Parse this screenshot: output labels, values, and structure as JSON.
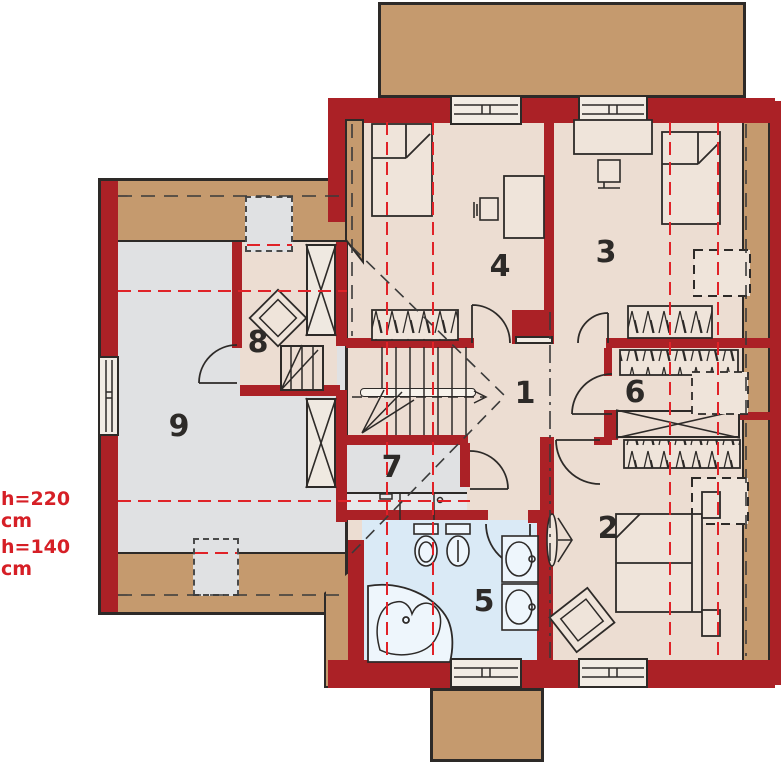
{
  "annotations": {
    "h220": "h=220 cm",
    "h140": "h=140 cm"
  },
  "rooms": [
    {
      "number": "1"
    },
    {
      "number": "2"
    },
    {
      "number": "3"
    },
    {
      "number": "4"
    },
    {
      "number": "5"
    },
    {
      "number": "6"
    },
    {
      "number": "7"
    },
    {
      "number": "8"
    },
    {
      "number": "9"
    }
  ],
  "colors": {
    "wall_red": "#ab2126",
    "roof_band_tan": "#c59a6e",
    "floor_beige": "#ecddd2",
    "floor_gray": "#e0e1e3",
    "floor_bath_blue": "#daeaf6",
    "outline_dark": "#2d2a28",
    "dashed_red": "#e02228",
    "annotation_red": "#d61f26"
  },
  "symbols": [
    "window-icon",
    "door-swing-icon",
    "bed-icon",
    "desk-icon",
    "chair-icon",
    "wardrobe-rail-icon",
    "roof-window-icon",
    "chimney-icon",
    "stairs-icon",
    "bathtub-icon",
    "toilet-icon",
    "bidet-icon",
    "washbasin-icon",
    "armchair-icon",
    "mirror-icon"
  ]
}
